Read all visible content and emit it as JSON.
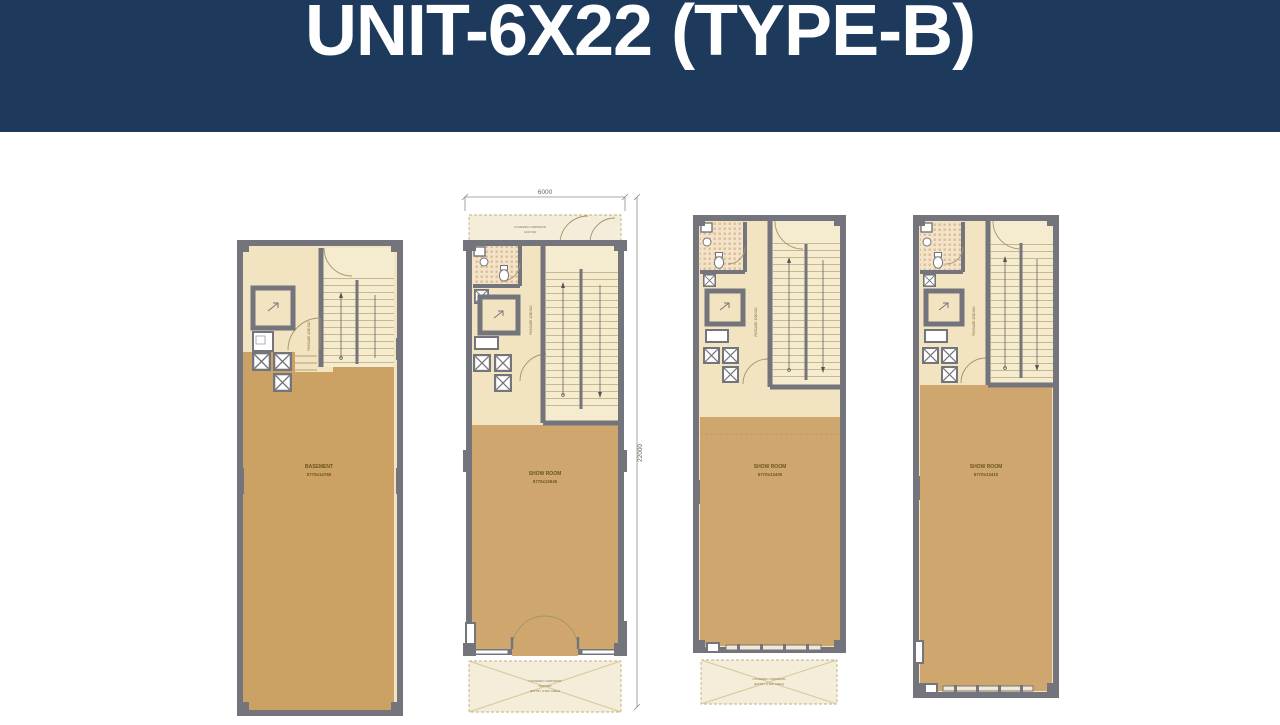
{
  "header": {
    "title": "UNIT-6X22 (TYPE-B)",
    "bg_color": "#1d3a5c",
    "text_color": "#ffffff"
  },
  "dimensions": {
    "width_label": "6000",
    "height_label": "22000"
  },
  "plans": [
    {
      "id": "basement",
      "room_label": "BASEMENT",
      "room_dims": "5770x14760",
      "passage_label": "PASSAGE 1200 WD"
    },
    {
      "id": "ground-floor",
      "room_label": "SHOW ROOM",
      "room_dims": "5770x12640",
      "passage_label": "PASSAGE 1200 WD",
      "top_corridor_line1": "COVERED CORRIDOR",
      "top_corridor_line2": "1200 WD",
      "bottom_corridor_line1": "COVERED CORRIDOR",
      "bottom_corridor_line2": "3000 WD",
      "bottom_corridor_line3": "(ENTRY STEP AREA)"
    },
    {
      "id": "first-floor",
      "room_label": "SHOW ROOM",
      "room_dims": "5770x13400",
      "passage_label": "PASSAGE 1200 WD",
      "bottom_corridor_line1": "COVERED CORRIDOR",
      "bottom_corridor_line2": "(ENTRY STEP AREA)"
    },
    {
      "id": "second-floor",
      "room_label": "SHOW ROOM",
      "room_dims": "5770x13410",
      "passage_label": "PASSAGE 1200 WD"
    }
  ],
  "colors": {
    "banner_navy": "#1d3a5c",
    "wall_gray": "#74747c",
    "floor_cream": "#f2e4c1",
    "stair_cream": "#f5ebcf",
    "showroom_tan": "#cfa76e",
    "basement_tan": "#cba263",
    "corridor_fill": "#f3edda"
  }
}
